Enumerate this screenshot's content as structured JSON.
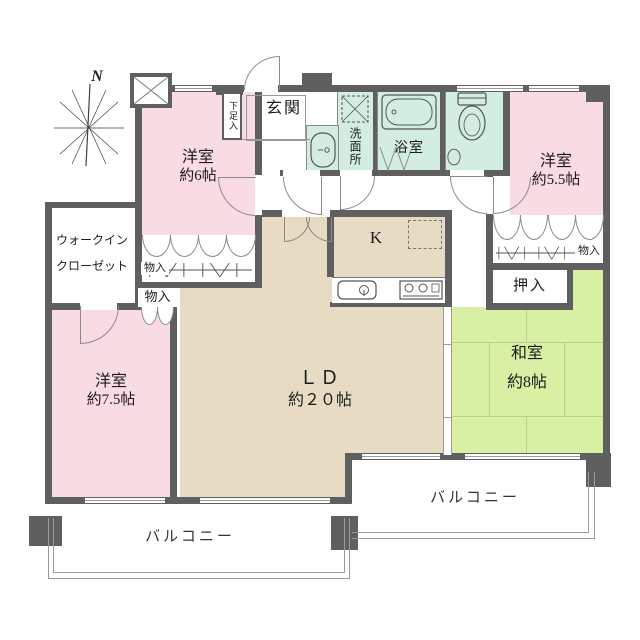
{
  "north": "N",
  "rooms": {
    "yo6": {
      "name": "洋室",
      "size": "約6帖"
    },
    "yo55": {
      "name": "洋室",
      "size": "約5.5帖"
    },
    "yo75": {
      "name": "洋室",
      "size": "約7.5帖"
    },
    "washitsu": {
      "name": "和室",
      "size": "約8帖"
    },
    "ld": {
      "name": "ＬＤ",
      "size": "約２０帖"
    },
    "kitchen": {
      "name": "K"
    },
    "genkan": {
      "name": "玄関"
    },
    "senmenjo": {
      "name": "洗面所"
    },
    "yokushitsu": {
      "name": "浴室"
    },
    "wic": {
      "line1": "ウォークイン",
      "line2": "クローゼット"
    },
    "oshiire": {
      "name": "押入"
    },
    "getabako": {
      "name": "下足入"
    },
    "storage_a": {
      "name": "物入"
    },
    "storage_b": {
      "name": "物入"
    },
    "storage_c": {
      "name": "物入"
    },
    "balcony_south": {
      "name": "バルコニー"
    },
    "balcony_east": {
      "name": "バルコニー"
    }
  },
  "colors": {
    "wall": "#5f5f5f",
    "western_room_pink": "#f9dbe3",
    "tatami_green": "#d9efa3",
    "living_beige": "#e7dcc3",
    "wet_area_teal": "#d3eee1",
    "line_gray": "#9a9a9a"
  }
}
